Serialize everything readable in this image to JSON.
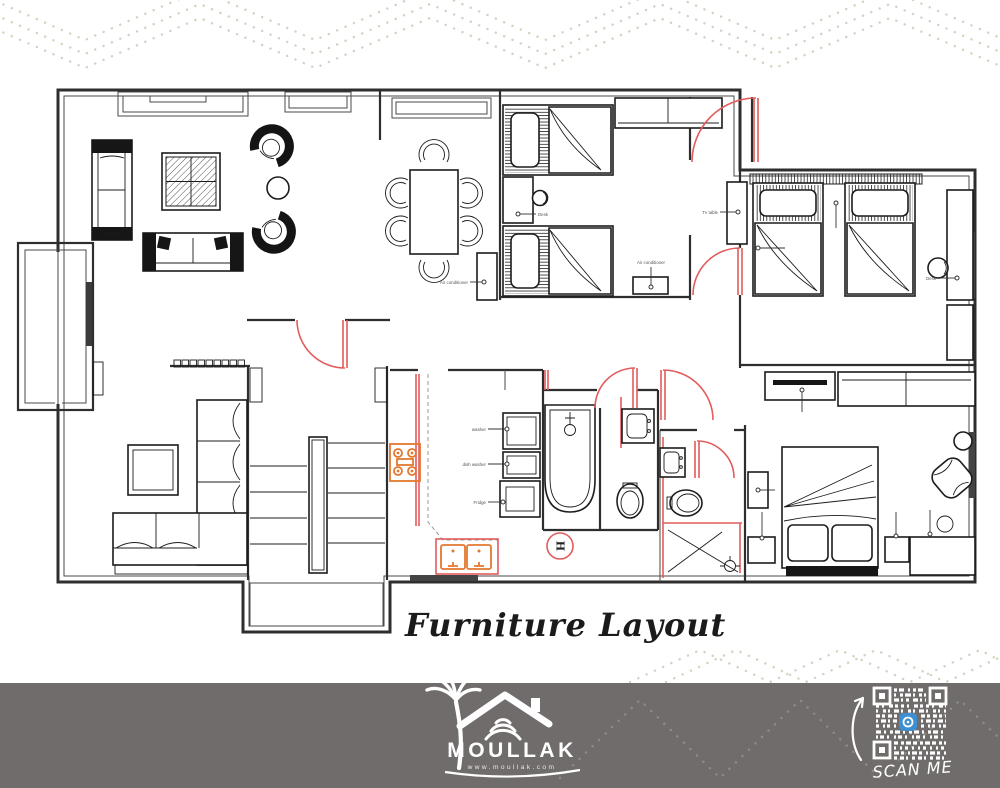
{
  "page": {
    "title": "Furniture Layout"
  },
  "plan": {
    "labels": {
      "washer": "washer",
      "dish_washer": "dish washer",
      "fridge": "Fridge",
      "air_conditioner_dining": "Air conditioner",
      "air_conditioner_bedroom": "Air conditioner",
      "desk_bedroom1": "Desk",
      "desk_bedroom2": "Desk",
      "tv_table": "Tv table",
      "heater_symbol": "H"
    },
    "colors": {
      "wall": "#2e2e2e",
      "door": "#e25c5c",
      "kitchen_fixture": "#e2782f",
      "pattern": "#ccd6bf"
    }
  },
  "footer": {
    "brand": "MOULLAK",
    "website": "www.moullak.com",
    "scan_label": "SCAN ME",
    "background": "#716c6c",
    "qr_icon_color": "#3d8fd1"
  }
}
